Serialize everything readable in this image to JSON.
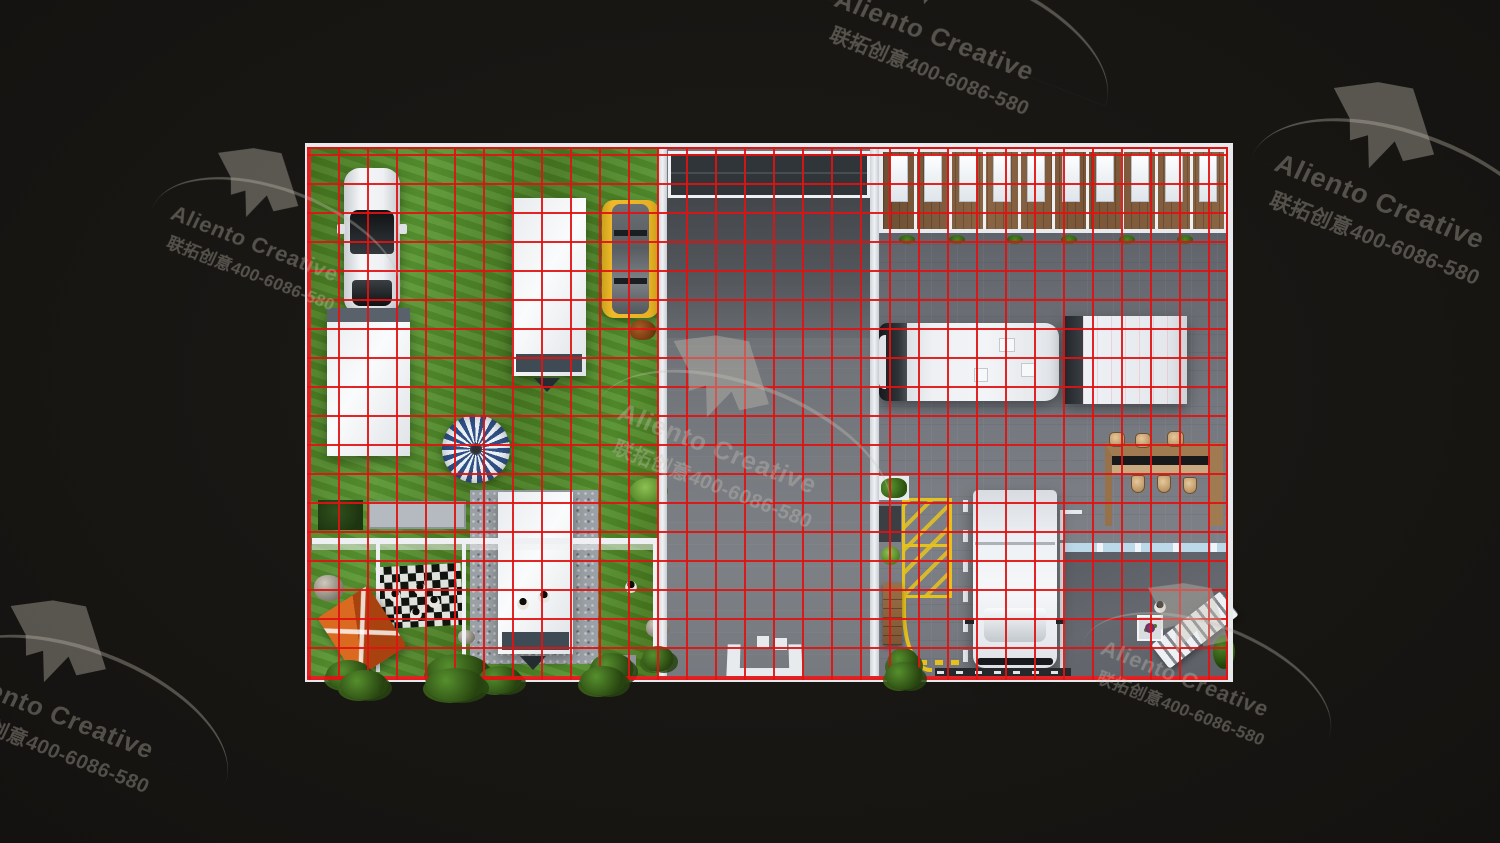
{
  "canvas": {
    "width": 1500,
    "height": 843
  },
  "colors": {
    "background": "#181613",
    "grid_line": "#e01212",
    "plan_wall_white": "#e7e9ed",
    "grass_green": "#4e8028",
    "yard_floor_gray": "#73777c",
    "wood_brown": "#8a6544",
    "marking_yellow": "#e6c11c",
    "tent_orange": "#c2581a",
    "parasol_blue": "#2f5186",
    "watermark_gray": "#8a867c"
  },
  "grid": {
    "spacing_px": 29,
    "line_px": 2
  },
  "watermark": {
    "brand": "Aliento Creative",
    "tagline": "联拓创意400-6086-580",
    "instances": [
      {
        "id": "top-left",
        "x": 199,
        "y": 120,
        "scale": 0.8
      },
      {
        "id": "top-center",
        "x": 868,
        "y": -111,
        "scale": 0.95
      },
      {
        "id": "top-right",
        "x": 1310,
        "y": 47,
        "scale": 1
      },
      {
        "id": "center",
        "x": 651,
        "y": 302,
        "scale": 0.95
      },
      {
        "id": "bottom-left",
        "x": -12,
        "y": 567,
        "scale": 0.95
      },
      {
        "id": "bottom-right",
        "x": 1129,
        "y": 555,
        "scale": 0.8
      }
    ]
  },
  "plan": {
    "dorm_rooms_count": 10,
    "bar_stool_count": 6,
    "plant_row_count": 6
  }
}
